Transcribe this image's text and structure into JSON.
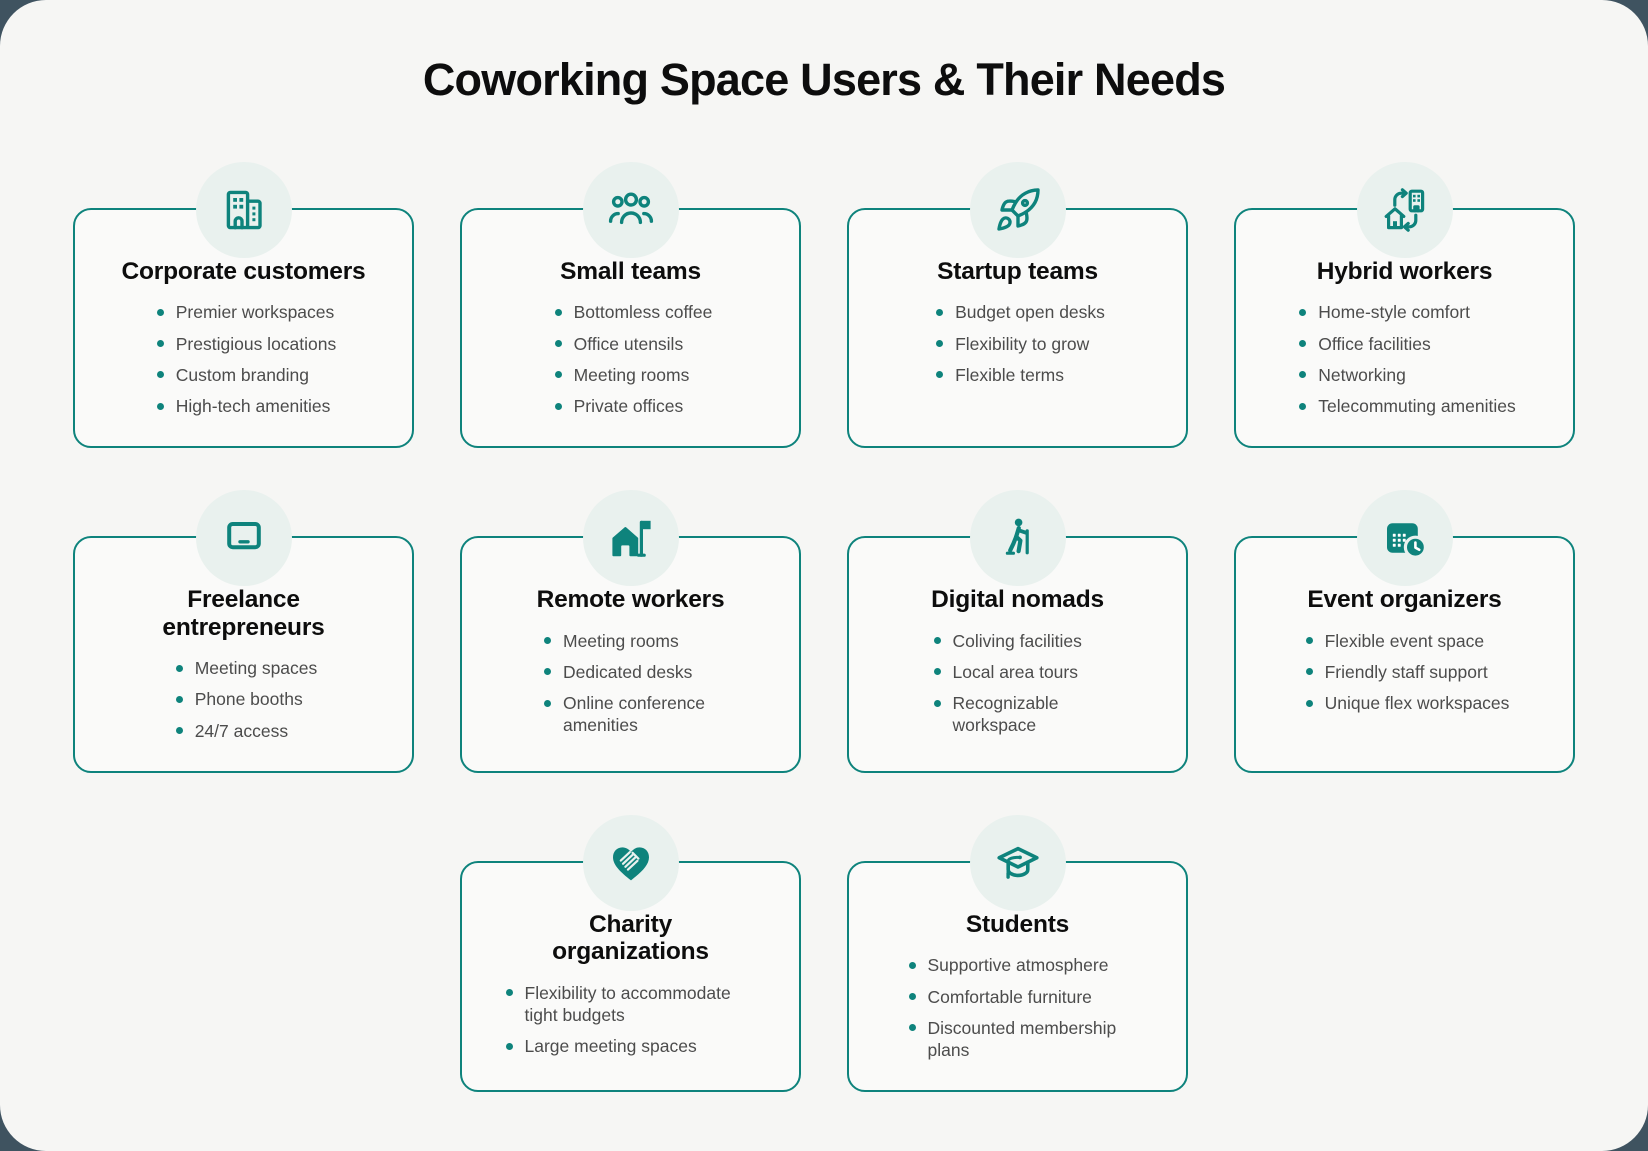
{
  "page": {
    "title": "Coworking Space Users & Their Needs"
  },
  "theme": {
    "accent_teal": "#0e837c",
    "icon_circle_bg": "#e9f1ee",
    "panel_bg": "#f6f6f4",
    "card_bg": "#fafaf9",
    "outer_bg": "#3f5360",
    "title_text": "#0d0d0d",
    "body_text": "#4c4c4c"
  },
  "cards": [
    {
      "id": "corporate-customers",
      "icon": "office-building-icon",
      "title": "Corporate customers",
      "items": [
        "Premier workspaces",
        "Prestigious locations",
        "Custom branding",
        "High-tech amenities"
      ]
    },
    {
      "id": "small-teams",
      "icon": "people-group-icon",
      "title": "Small teams",
      "items": [
        "Bottomless coffee",
        "Office utensils",
        "Meeting rooms",
        "Private offices"
      ]
    },
    {
      "id": "startup-teams",
      "icon": "rocket-icon",
      "title": "Startup teams",
      "items": [
        "Budget open desks",
        "Flexibility to grow",
        "Flexible terms"
      ]
    },
    {
      "id": "hybrid-workers",
      "icon": "home-office-swap-icon",
      "title": "Hybrid workers",
      "items": [
        "Home-style comfort",
        "Office facilities",
        "Networking",
        "Telecommuting amenities"
      ]
    },
    {
      "id": "freelance-entrepreneurs",
      "icon": "laptop-icon",
      "title": "Freelance\nentrepreneurs",
      "items": [
        "Meeting spaces",
        "Phone booths",
        "24/7 access"
      ]
    },
    {
      "id": "remote-workers",
      "icon": "house-flag-icon",
      "title": "Remote workers",
      "items": [
        "Meeting rooms",
        "Dedicated desks",
        "Online conference amenities"
      ]
    },
    {
      "id": "digital-nomads",
      "icon": "hiker-icon",
      "title": "Digital nomads",
      "items": [
        "Coliving facilities",
        "Local area tours",
        "Recognizable workspace"
      ]
    },
    {
      "id": "event-organizers",
      "icon": "calendar-clock-icon",
      "title": "Event organizers",
      "items": [
        "Flexible event space",
        "Friendly staff support",
        "Unique flex workspaces"
      ]
    },
    {
      "id": "charity-organizations",
      "icon": "heart-hand-icon",
      "title": "Charity\norganizations",
      "items": [
        "Flexibility to accommodate tight budgets",
        "Large meeting spaces"
      ]
    },
    {
      "id": "students",
      "icon": "graduation-cap-icon",
      "title": "Students",
      "items": [
        "Supportive atmosphere",
        "Comfortable furniture",
        "Discounted membership plans"
      ]
    }
  ]
}
